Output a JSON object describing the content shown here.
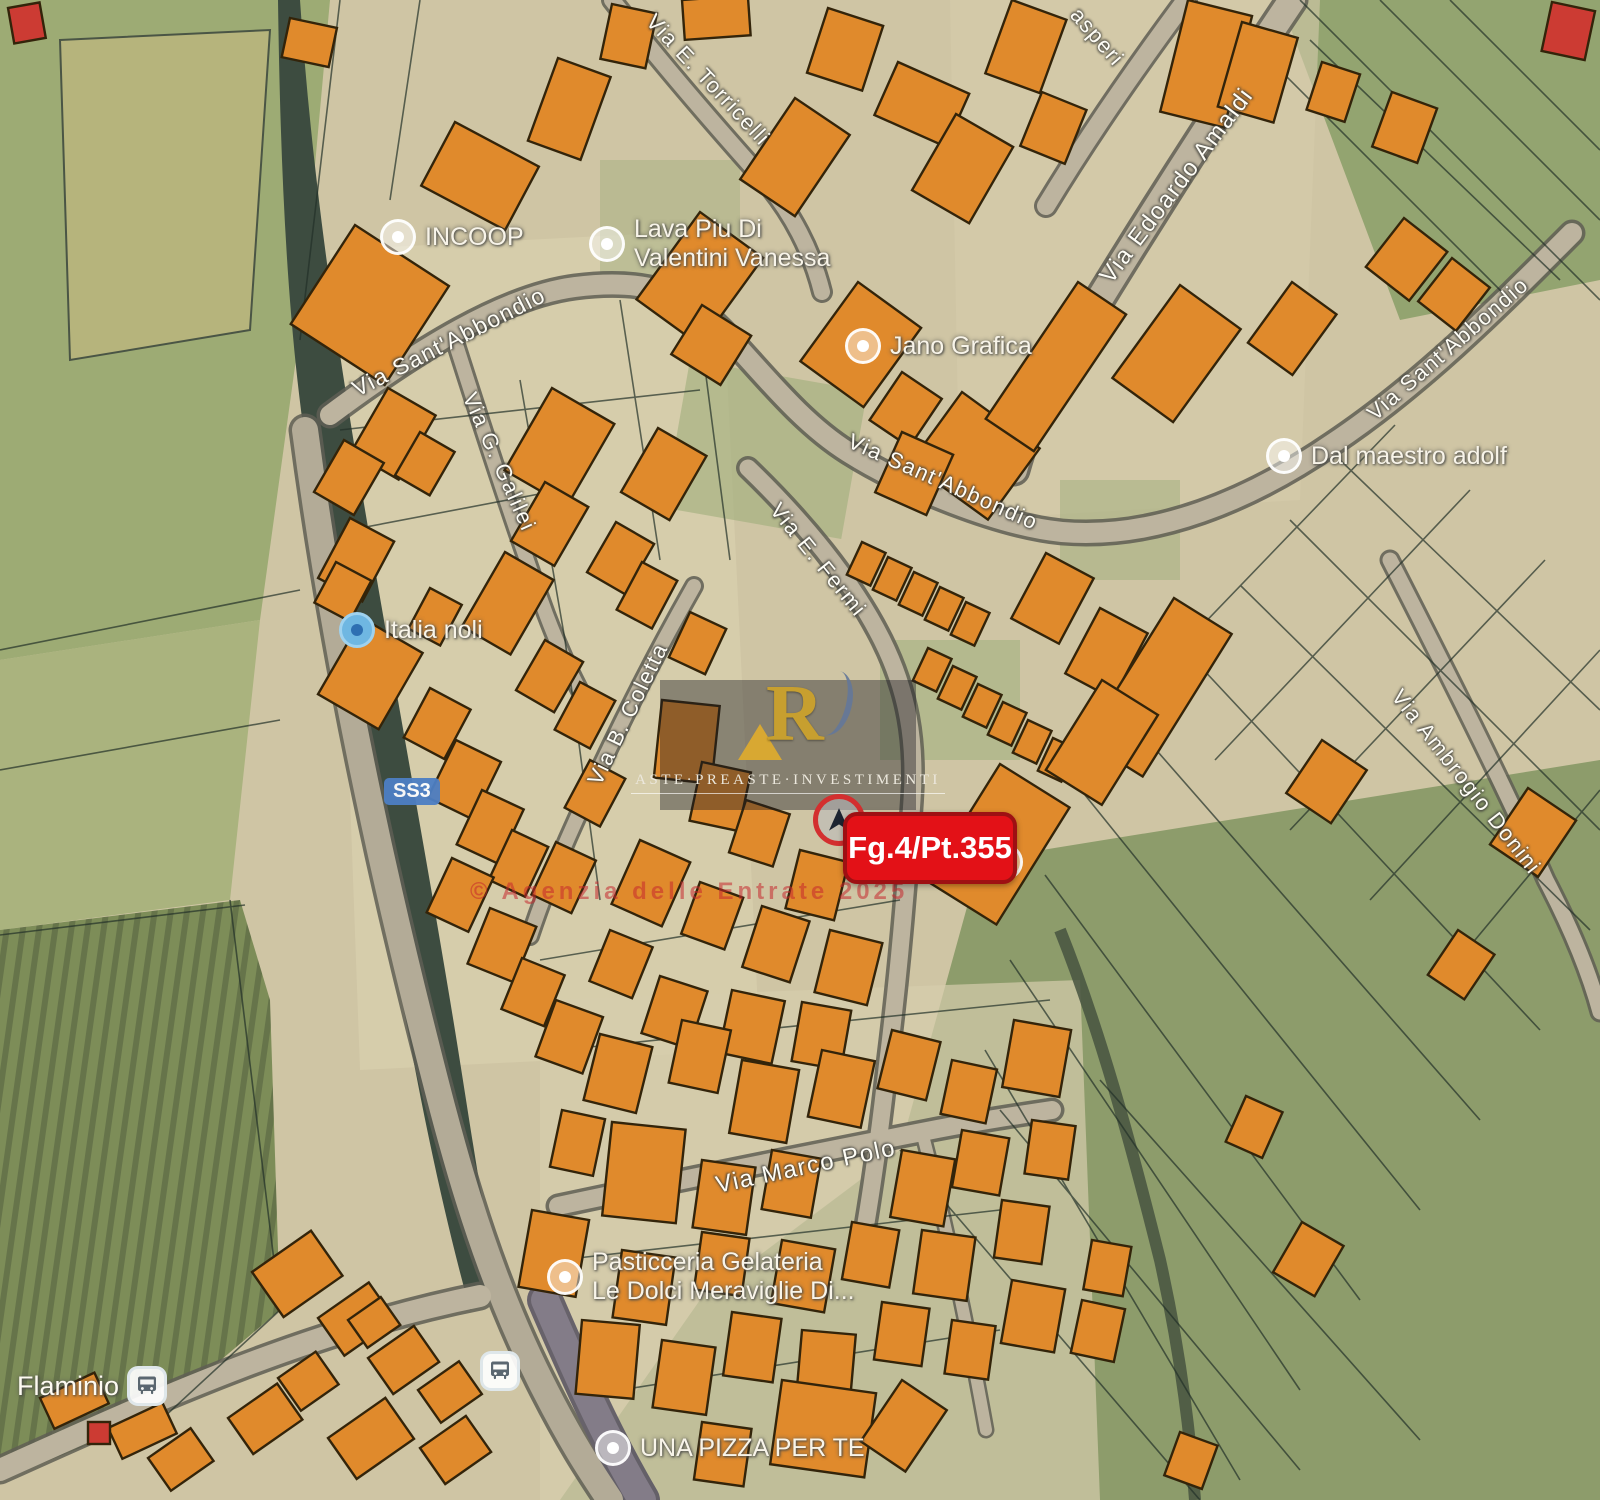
{
  "map": {
    "marker": {
      "label": "Fg.4/Pt.355",
      "color": "#e31117",
      "ring_color": "#d32f2f"
    },
    "road_badge": {
      "label": "SS3",
      "color": "#4d7fc4"
    },
    "watermark": {
      "monogram": "R",
      "text": "ASTE·PREASTE·INVESTIMENTI",
      "gold": "#c79f2f"
    },
    "copyright": "© Agenzia delle Entrate 2025",
    "colors": {
      "building": "#e08a2c",
      "building_outline": "#33240a",
      "field_green": "#9dab74",
      "road": "#bdb49f",
      "parcel_line": "#223028"
    },
    "street_labels": [
      {
        "text": "Via Sant'Abbondio",
        "x": 449,
        "y": 342,
        "rot": -27,
        "size": 23
      },
      {
        "text": "Via Sant'Abbondio",
        "x": 943,
        "y": 482,
        "rot": 24,
        "size": 22
      },
      {
        "text": "Via Sant'Abbondio",
        "x": 1448,
        "y": 349,
        "rot": -41,
        "size": 22
      },
      {
        "text": "Via Edoardo Amaldi",
        "x": 1177,
        "y": 186,
        "rot": -53,
        "size": 24
      },
      {
        "text": "Via E. Torricelli",
        "x": 708,
        "y": 80,
        "rot": 47,
        "size": 22
      },
      {
        "text": "asperi",
        "x": 1097,
        "y": 37,
        "rot": 49,
        "size": 22
      },
      {
        "text": "Via G. Galilei",
        "x": 499,
        "y": 462,
        "rot": 66,
        "size": 22
      },
      {
        "text": "Via B. Coletta",
        "x": 628,
        "y": 714,
        "rot": -64,
        "size": 22
      },
      {
        "text": "Via E. Fermi",
        "x": 818,
        "y": 560,
        "rot": 51,
        "size": 22
      },
      {
        "text": "Via Ambrogio Donini",
        "x": 1466,
        "y": 782,
        "rot": 52,
        "size": 22
      },
      {
        "text": "Via Marco Polo",
        "x": 806,
        "y": 1167,
        "rot": -12,
        "size": 24
      }
    ],
    "poi_labels": [
      {
        "icon": "white",
        "x": 398,
        "y": 237,
        "lines": [
          "INCOOP"
        ]
      },
      {
        "icon": "white",
        "x": 607,
        "y": 233,
        "lines": [
          "Lava Piu Di",
          "Valentini Vanessa"
        ]
      },
      {
        "icon": "white",
        "x": 863,
        "y": 346,
        "lines": [
          "Jano Grafica"
        ]
      },
      {
        "icon": "white",
        "x": 1284,
        "y": 456,
        "lines": [
          "Dal maestro adolf"
        ]
      },
      {
        "icon": "blue",
        "x": 357,
        "y": 630,
        "lines": [
          "Italia noli"
        ]
      },
      {
        "icon": "white",
        "x": 565,
        "y": 1266,
        "lines": [
          "Pasticceria Gelateria",
          "Le Dolci Meraviglie Di..."
        ]
      },
      {
        "icon": "white",
        "x": 613,
        "y": 1448,
        "lines": [
          "UNA PIZZA PER TE"
        ]
      },
      {
        "icon": "white",
        "x": 1005,
        "y": 862,
        "lines": []
      }
    ],
    "bus_stops": [
      {
        "x": 147,
        "y": 1386,
        "label": "Flaminio"
      },
      {
        "x": 500,
        "y": 1371,
        "label": ""
      }
    ]
  }
}
